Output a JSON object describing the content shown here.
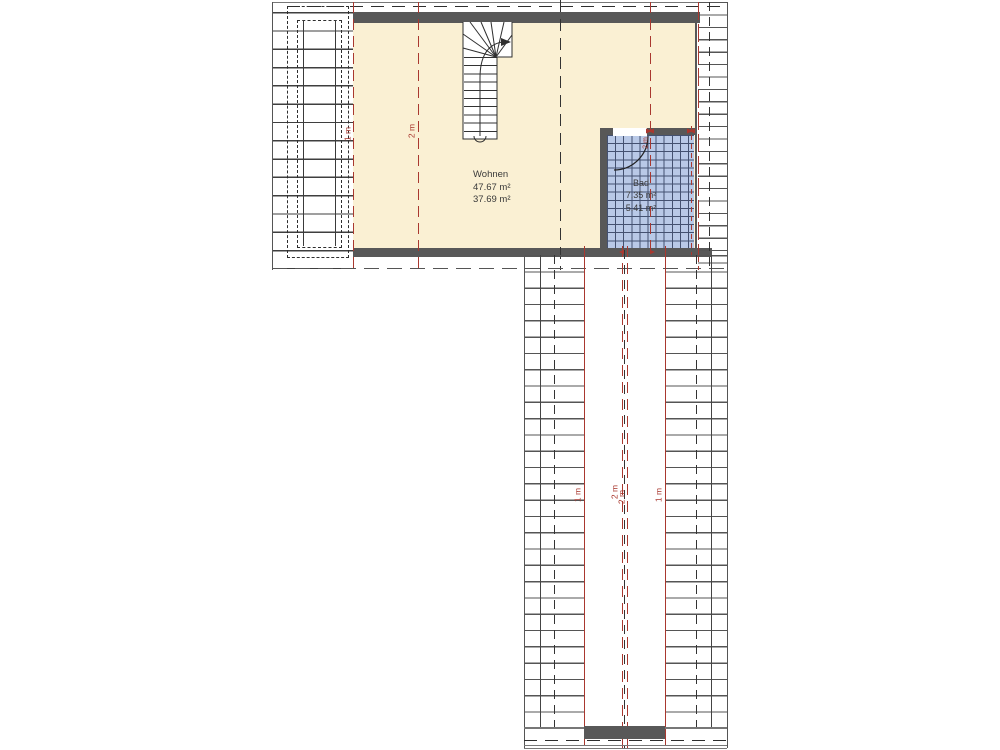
{
  "plan": {
    "rooms": {
      "wohnen": {
        "name": "Wohnen",
        "area_gross": "47.67 m²",
        "area_net": "37.69 m²"
      },
      "bad": {
        "name": "Bad",
        "area_gross": "7.35 m²",
        "area_net": "5.41 m²"
      }
    },
    "height_markers": {
      "left_1m": "1 m",
      "left_2m": "2 m",
      "bath_2m": "2 m",
      "corridor_left_1m": "1 m",
      "corridor_2m_a": "2 m",
      "corridor_2m_b": "2 m",
      "corridor_right_1m": "1 m"
    },
    "colors": {
      "floor": "#faf0d3",
      "tile": "#b9c9e7",
      "tilegrid": "#445170",
      "wall": "#585858",
      "red": "#a9382f",
      "gray": "#777777",
      "black": "#333333"
    }
  }
}
